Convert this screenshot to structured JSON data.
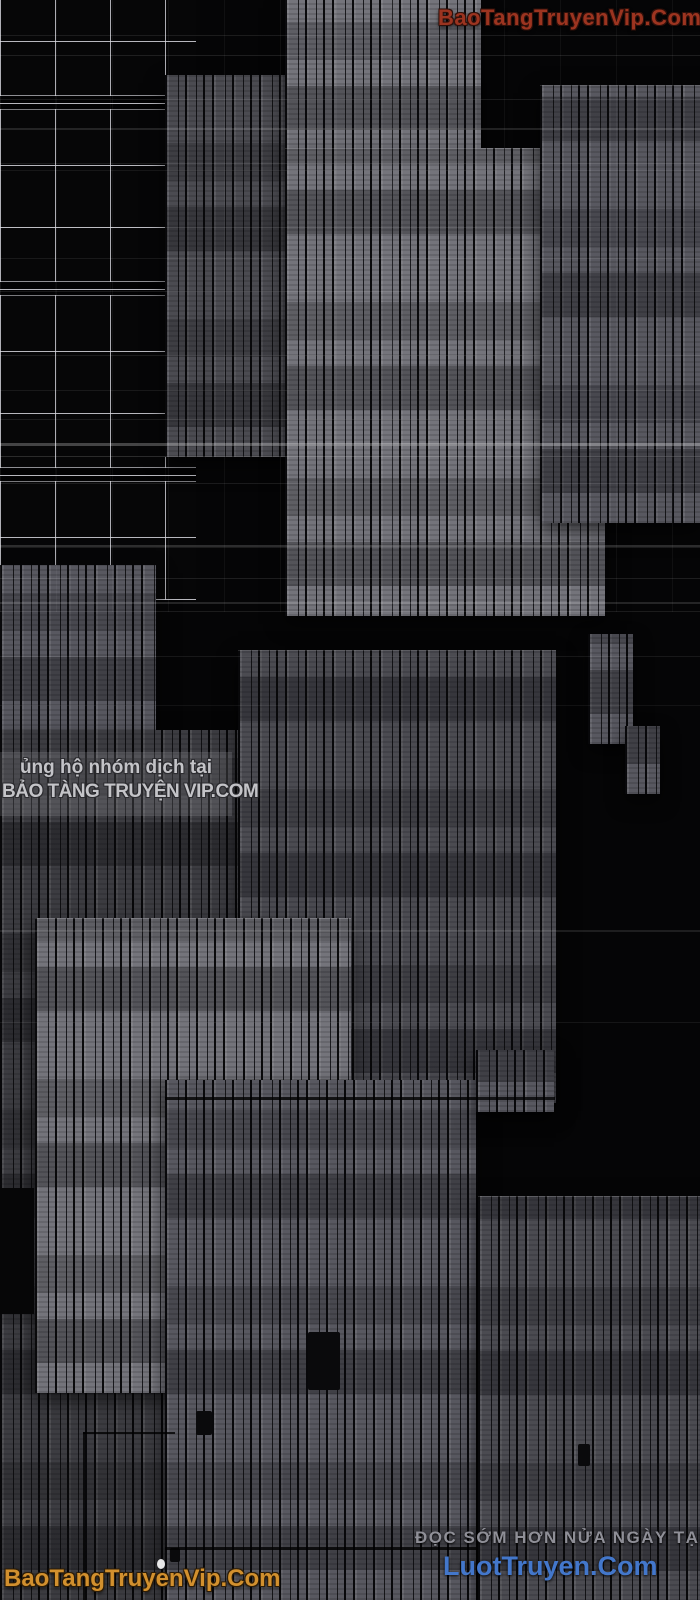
{
  "watermarks": {
    "top_right": {
      "text": "BaoTangTruyenVip.Com",
      "color": "#9c3420"
    },
    "mid_left": {
      "line1": "ủng hộ nhóm dịch tại",
      "line2": "BẢO TÀNG TRUYỆN VIP.COM",
      "color": "#cfcfd3"
    },
    "bottom_right": {
      "line1": "ĐỌC SỚM HƠN NỬA NGÀY TẠI",
      "line2": "LuotTruyen.Com",
      "line1_color": "#8f8f97",
      "line2_color": "#4377cb"
    },
    "bottom_left": {
      "text": "BaoTangTruyenVip.Com",
      "color": "#d2902e"
    }
  },
  "scene": {
    "background_color": "#050506",
    "shelf_tones": [
      "#3c3c41",
      "#4b4b51",
      "#585860",
      "#74747b"
    ]
  }
}
